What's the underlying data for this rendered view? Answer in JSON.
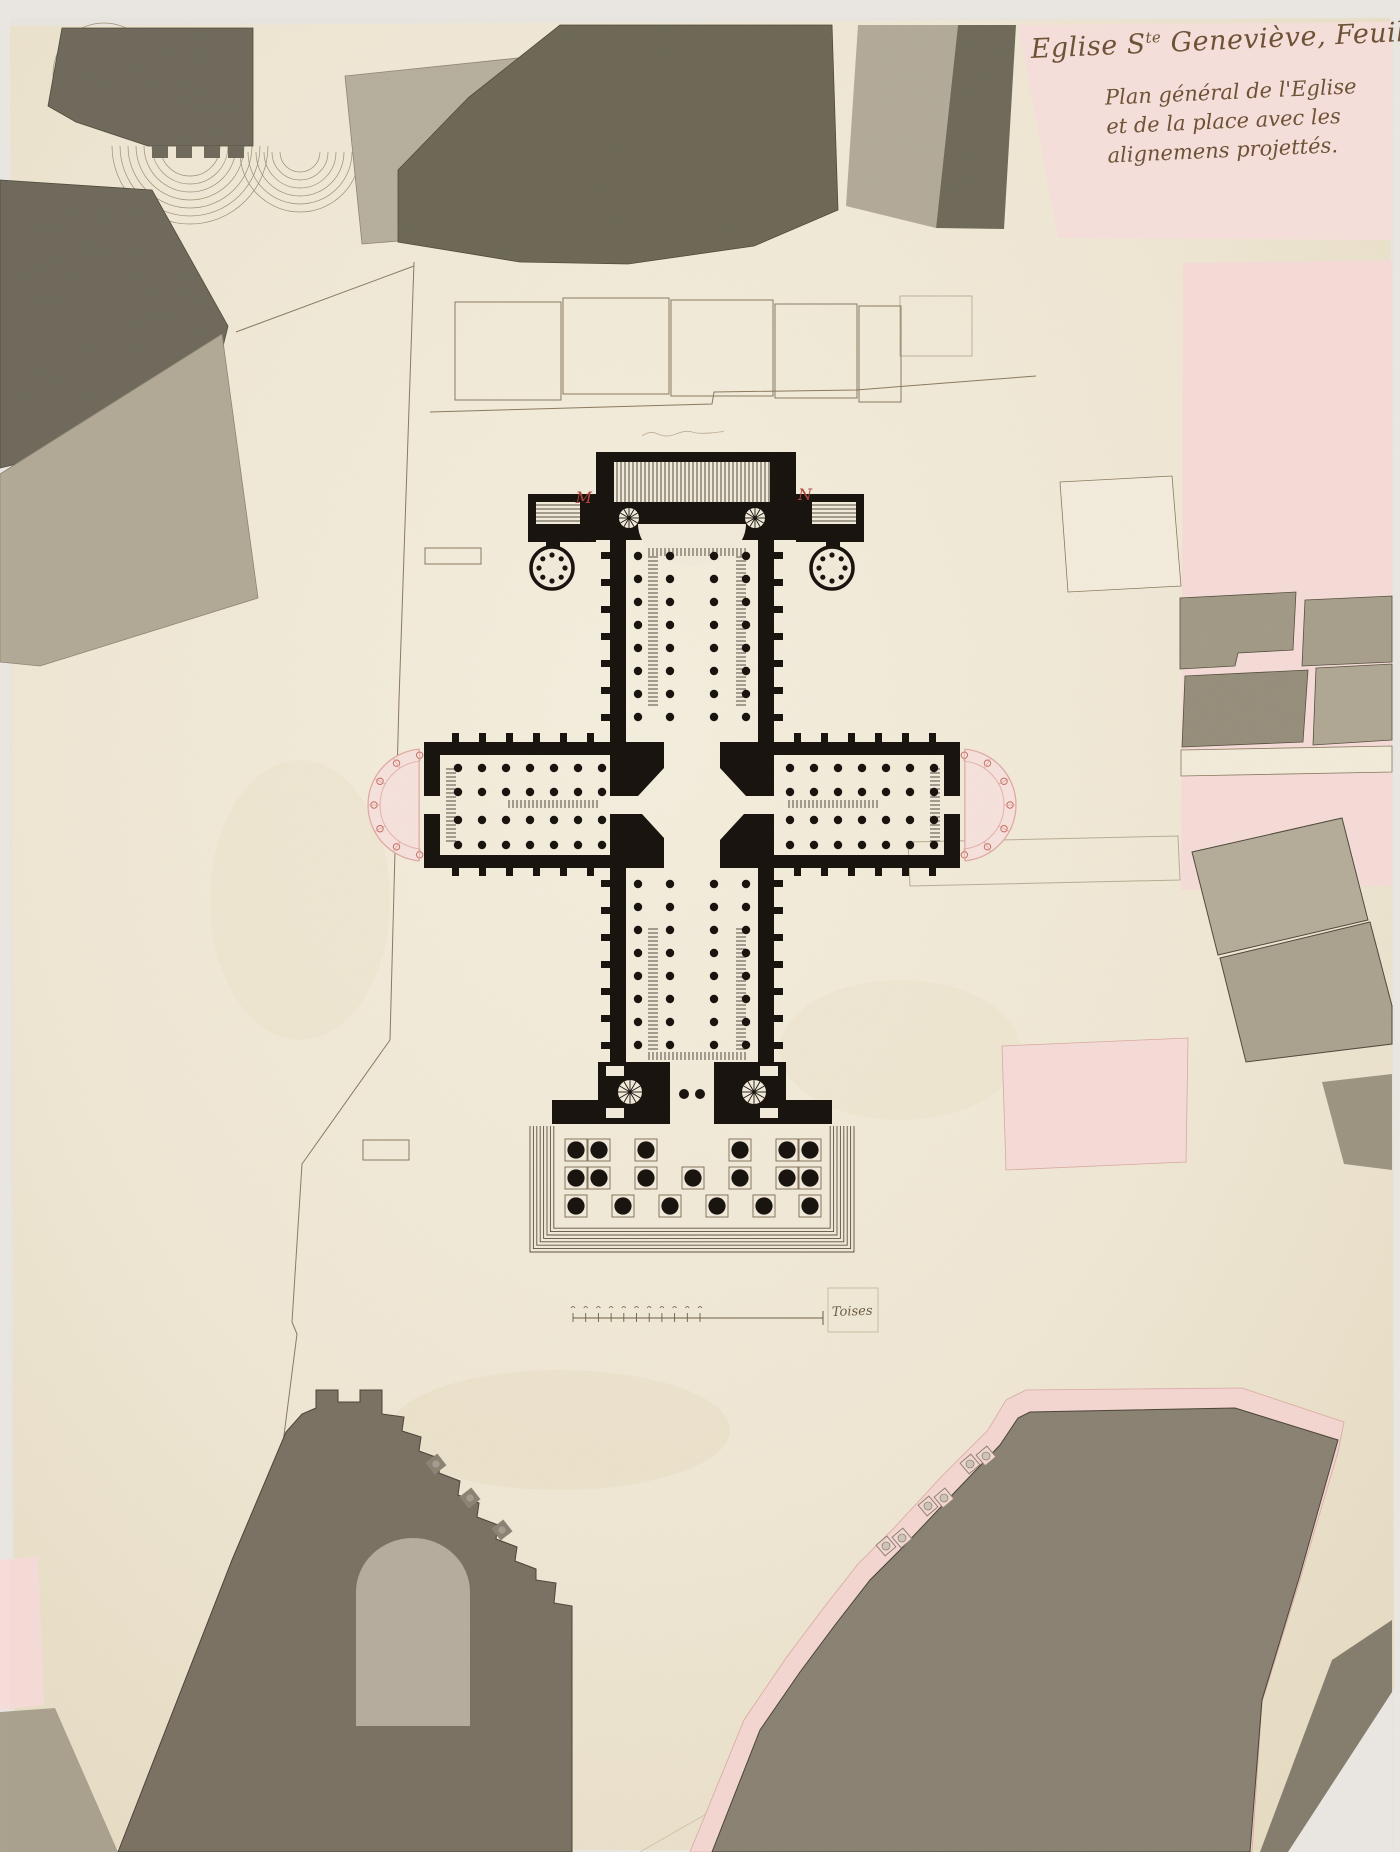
{
  "drawing": {
    "title": {
      "main_prefix": "Eglise S",
      "main_sup1": "te",
      "main_mid": " Geneviève, Feuille 1",
      "main_sup2": "ère"
    },
    "subtitle_lines": [
      "Plan général de l'Eglise",
      "et de la place avec les",
      "alignemens projettés."
    ],
    "scale_label": "Toises",
    "reference_letters": {
      "left": "M",
      "right": "N"
    },
    "palette": {
      "paper": "#f2ebdb",
      "building_wash_dark": "#6e6958",
      "building_wash_light": "#b5ad9a",
      "projected_pink": "#f6dcd8",
      "ink_black": "#17120d",
      "reference_red": "#b5443a",
      "line_ink": "#8a7a5f"
    }
  }
}
